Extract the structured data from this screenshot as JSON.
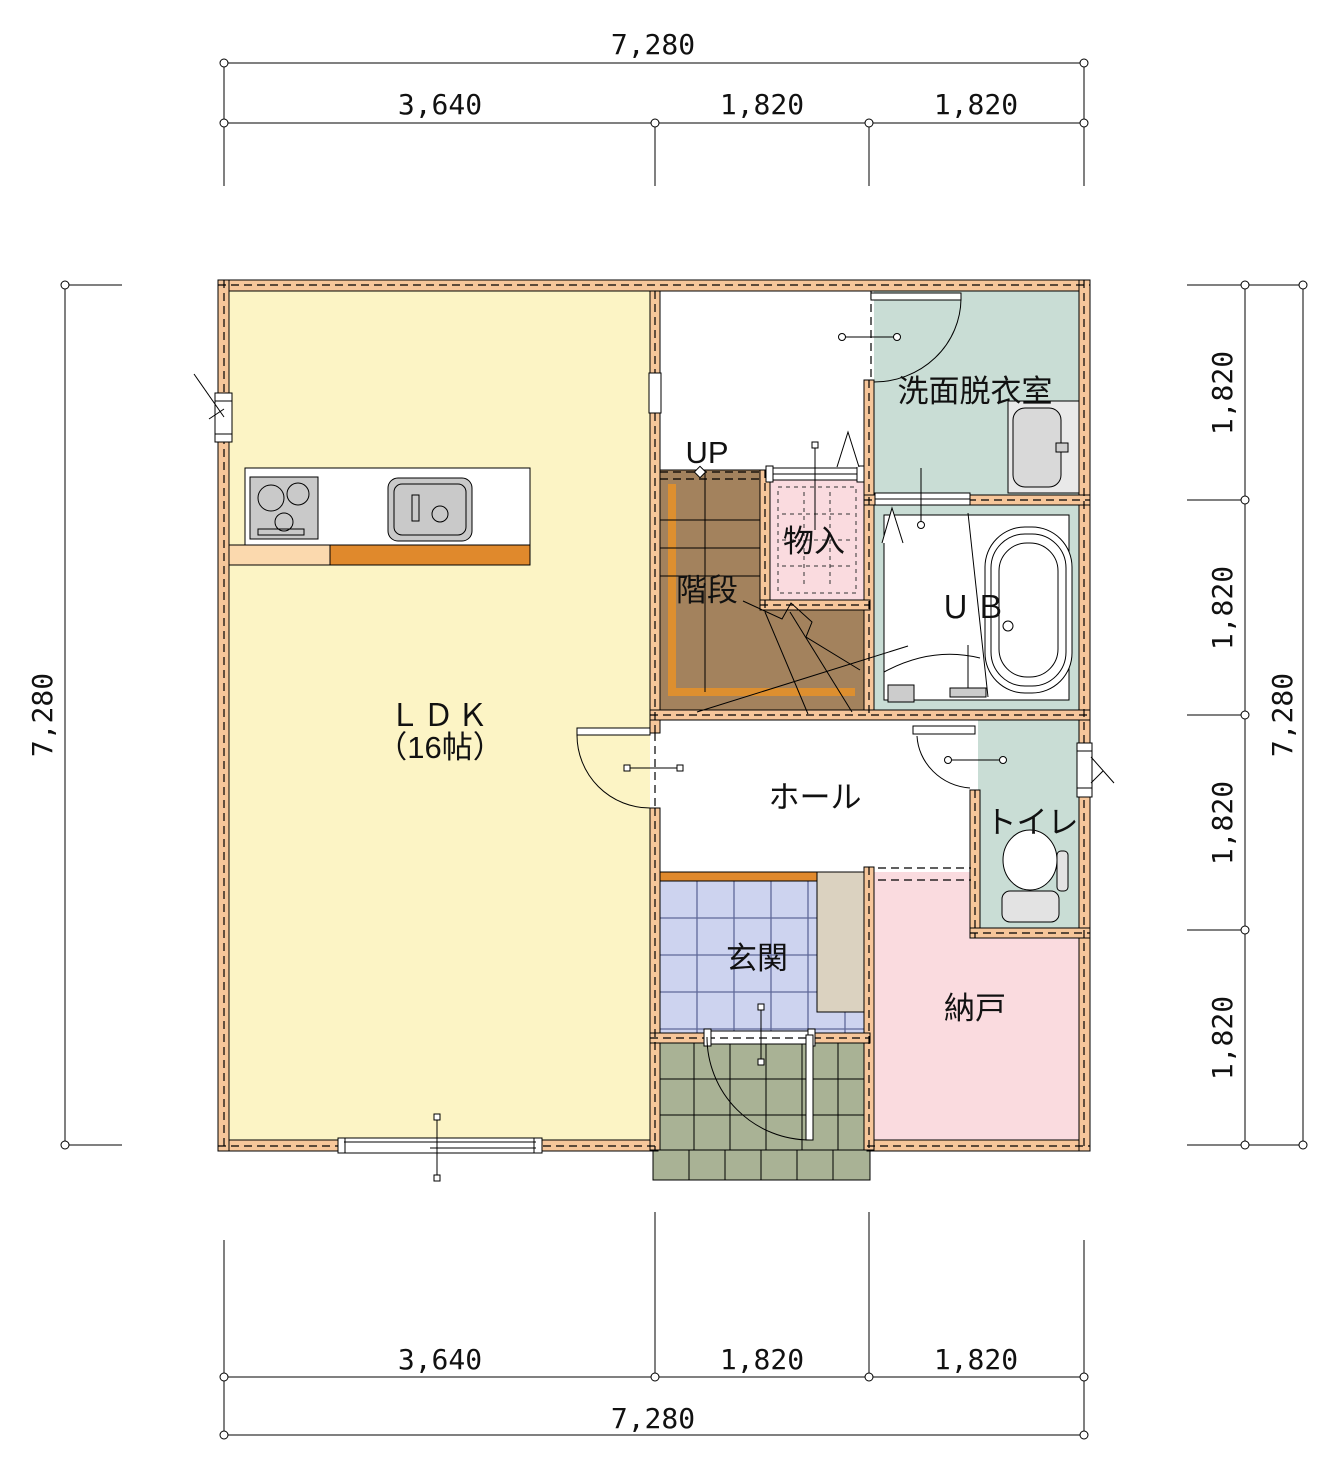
{
  "dimensions": {
    "top": {
      "total": "7,280",
      "segments": [
        "3,640",
        "1,820",
        "1,820"
      ]
    },
    "bottom": {
      "total": "7,280",
      "segments": [
        "3,640",
        "1,820",
        "1,820"
      ]
    },
    "left": {
      "total": "7,280"
    },
    "right": {
      "total": "7,280",
      "segments": [
        "1,820",
        "1,820",
        "1,820",
        "1,820"
      ]
    }
  },
  "rooms": {
    "ldk": {
      "label": "ＬＤＫ",
      "size": "（16帖）"
    },
    "washroom": {
      "label": "洗面脱衣室"
    },
    "closet": {
      "label": "物入"
    },
    "stairs": {
      "label": "階段",
      "direction": "UP"
    },
    "bath": {
      "label": "ＵＢ"
    },
    "hall": {
      "label": "ホール"
    },
    "toilet": {
      "label": "トイレ"
    },
    "entrance": {
      "label": "玄関"
    },
    "storage": {
      "label": "納戸"
    }
  },
  "colors": {
    "wall": "#f6c69a",
    "ldk_floor": "#fcf4c5",
    "wet_room": "#c9ddd5",
    "storage_pink": "#fadbdf",
    "stair_brown": "#a3825d",
    "stair_rail": "#dd8f2f",
    "entrance_tile": "#cdd3ef",
    "porch_tile": "#a9b295",
    "counter_front": "#e0892c",
    "half_wall": "#fbd9ae",
    "cabinet": "#dbd2c0",
    "fixture_gray": "#c9c9c9"
  }
}
